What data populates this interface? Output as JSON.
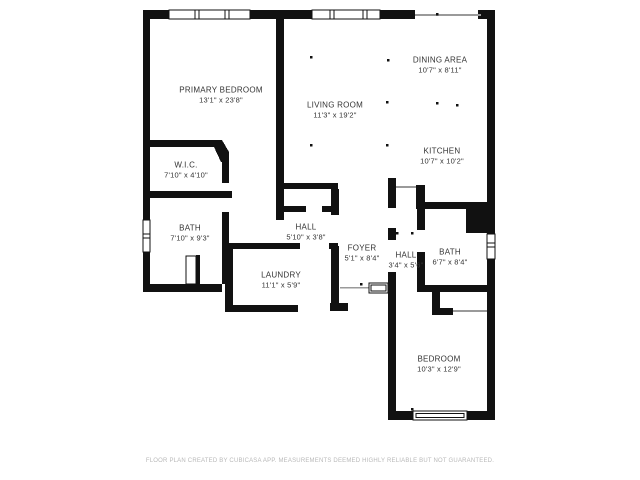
{
  "rooms": [
    {
      "name": "PRIMARY BEDROOM",
      "dims": "13'1\" x 23'8\""
    },
    {
      "name": "LIVING ROOM",
      "dims": "11'3\" x 19'2\""
    },
    {
      "name": "DINING AREA",
      "dims": "10'7\" x 8'11\""
    },
    {
      "name": "KITCHEN",
      "dims": "10'7\" x 10'2\""
    },
    {
      "name": "W.I.C.",
      "dims": "7'10\" x 4'10\""
    },
    {
      "name": "BATH",
      "dims": "7'10\" x 9'3\""
    },
    {
      "name": "HALL",
      "dims": "5'10\" x 3'8\""
    },
    {
      "name": "LAUNDRY",
      "dims": "11'1\" x 5'9\""
    },
    {
      "name": "FOYER",
      "dims": "5'1\" x 8'4\""
    },
    {
      "name": "HALL",
      "dims": "3'4\" x 5'6\""
    },
    {
      "name": "BATH",
      "dims": "6'7\" x 8'4\""
    },
    {
      "name": "BEDROOM",
      "dims": "10'3\" x 12'9\""
    }
  ],
  "footer": {
    "disclaimer": "FLOOR PLAN CREATED BY CUBICASA APP. MEASUREMENTS DEEMED HIGHLY RELIABLE BUT NOT GUARANTEED."
  },
  "colors": {
    "wall": "#111111",
    "label_text": "#333333",
    "footer_text": "#b9b9b9",
    "background": "#ffffff"
  }
}
